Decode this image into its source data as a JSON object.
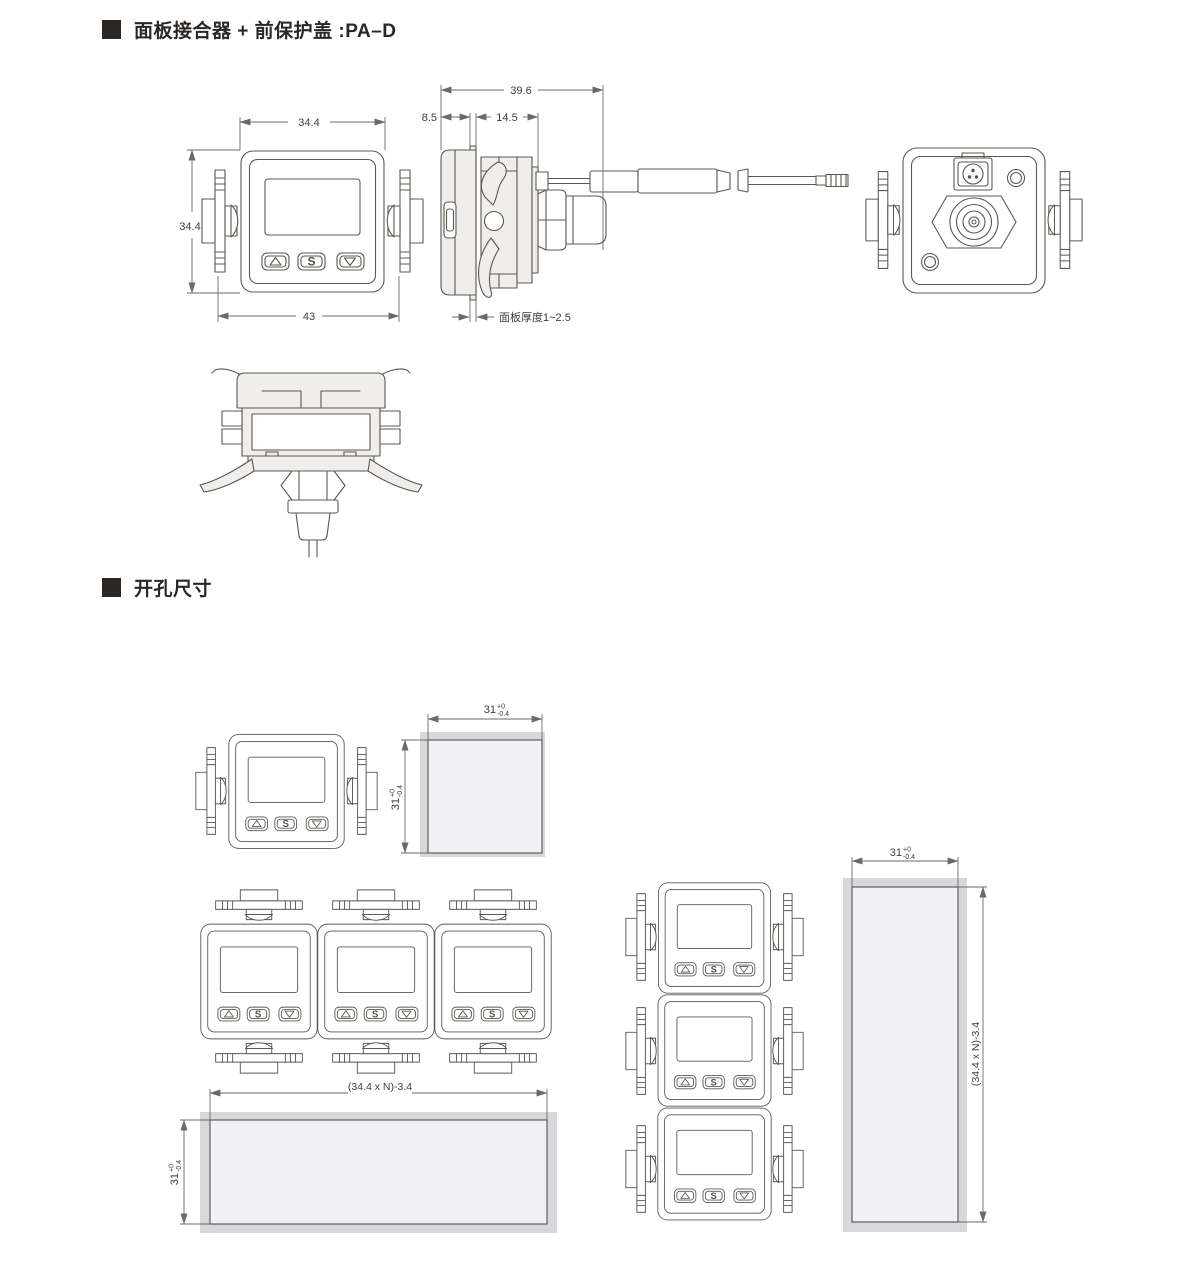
{
  "page": {
    "section1_title": "面板接合器 + 前保护盖 :PA–D",
    "section2_title": "开孔尺寸"
  },
  "device": {
    "set_label": "S"
  },
  "dims": {
    "front_width": "34.4",
    "front_height": "34.4",
    "front_overall": "43",
    "side_total_depth": "39.6",
    "side_front_depth": "8.5",
    "side_adapter_depth": "14.5",
    "panel_thickness_note": "面板厚度1~2.5",
    "cutout_nominal": "31",
    "tol_upper": "+0",
    "tol_lower": "-0.4",
    "gang_formula": "(34.4 x N)-3.4"
  },
  "colors": {
    "line": "#5b5853",
    "dimension_line": "#6a6a6d",
    "panel_gray": "#d7d8d9",
    "hole_fill": "#f1f1f3",
    "part_fill": "#efeeec",
    "heading_text": "#2b2724"
  }
}
